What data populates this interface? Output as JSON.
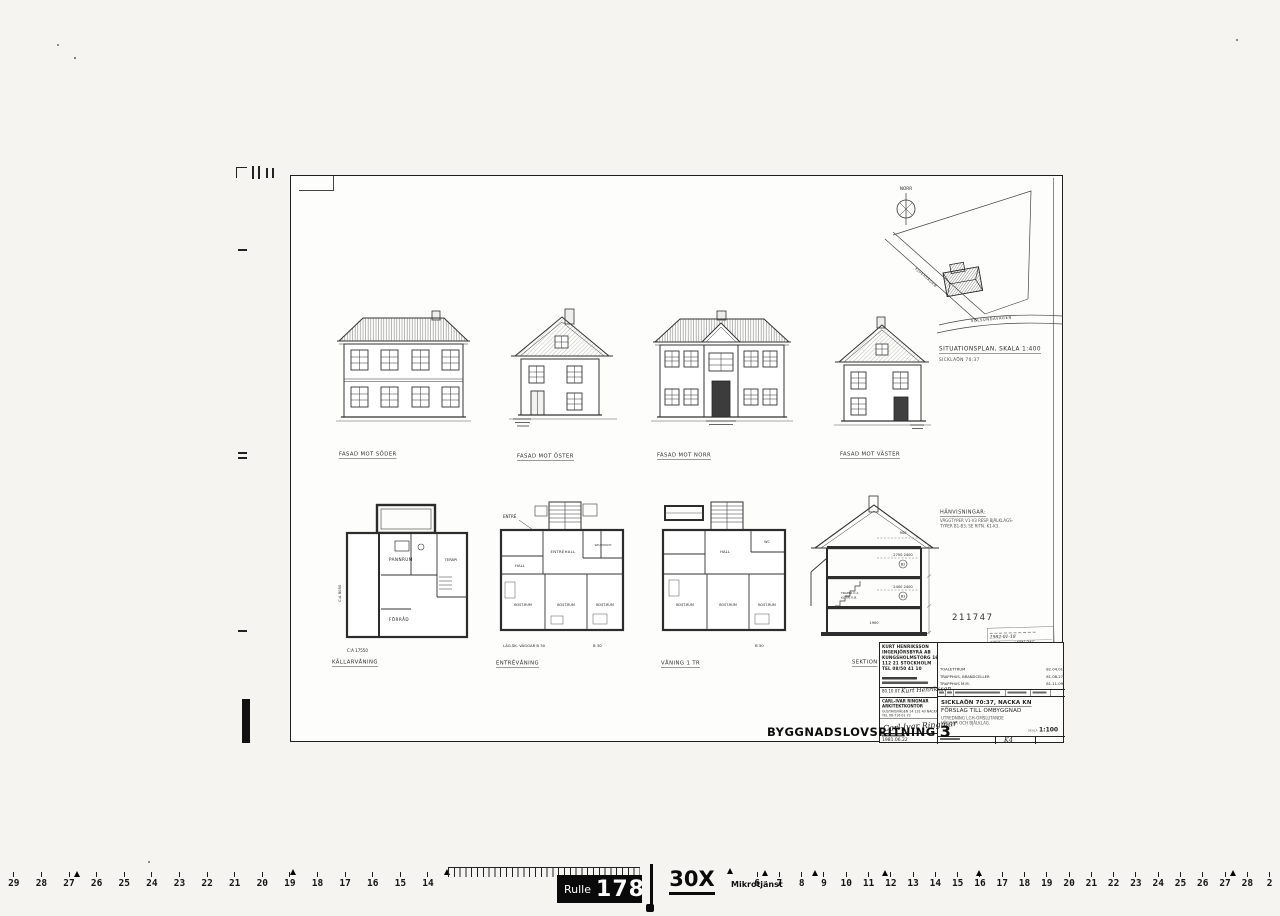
{
  "sheet": {
    "drawing_type_label": "BYGGNADSLOVSRITNING",
    "drawing_sheet_number": "3",
    "stamp_number": "211747"
  },
  "facades": {
    "south_label": "FASAD MOT SÖDER",
    "east_label": "FASAD MOT ÖSTER",
    "north_label": "FASAD MOT NORR",
    "west_label": "FASAD MOT VÄSTER"
  },
  "siteplan": {
    "north": "NORR",
    "street_diagonal": "EJDERVÄGEN",
    "street_bottom": "SOLSUNDAVÄGEN",
    "title": "SITUATIONSPLAN, SKALA 1:400",
    "subtitle": "SICKLAÖN 70:37"
  },
  "plans": {
    "basement_label": "KÄLLARVÅNING",
    "entry_label": "ENTRÉVÅNING",
    "floor1_label": "VÅNING 1 TR",
    "section_label": "SEKTION",
    "basement": {
      "room1": "PANNRUM",
      "room2": "TERAPI",
      "room3": "FÖRRÅD",
      "dim_bottom": "C:A 17550",
      "dim_left": "C:A 8050"
    },
    "entry": {
      "entry": "ENTRÉ",
      "hall_big": "ENTRÉHALL",
      "wc": "WC/DUSCH",
      "hall": "HALL",
      "room": "BOST.RUM",
      "note_left": "LÄG.SK. VÄGGAR  B 30",
      "note_right": "B 30"
    },
    "floor1": {
      "wc": "WC",
      "hall": "HALL",
      "room": "BOST.RUM",
      "note": "B 30"
    },
    "section": {
      "dim_attic": "900",
      "dim_upper": "2700  2400",
      "marker_upper": "B2",
      "dim_lower": "2400  2400",
      "marker_lower": "B3",
      "dim_basement": "1900",
      "stair_note1": "TRAPPA  C:A",
      "stair_note2": "KL.FRI  K.B."
    }
  },
  "notes": {
    "heading": "HÄNVISNINGAR:",
    "line1": "VÄGGTYPER V1-V3 RESP BJÄLKLAGS-",
    "line2": "TYPER B1-B3, SE RITN. K1-K3."
  },
  "titleblock": {
    "engineer_lines": [
      "KURT HENRIKSSON",
      "INGENJÖRSBYRÅ AB",
      "KUNGSHOLMSTORG 16",
      "112 21 STOCKHOLM",
      "TEL 08/50 41 10"
    ],
    "engineer_date": "80.10.07",
    "engineer_signature": "Kurt Henriksson",
    "architect_name": "CARL-IVAR RINGMAR ARKITEKTKONTOR",
    "architect_addr": "GUSTAVSVÄGEN 14    131 40 NACKA",
    "architect_tel": "TEL 08-716 01 72",
    "architect_signature": "Carl-Ivar Ringmar",
    "date": "1981.06.22",
    "revisions": [
      {
        "text": "TOALETTRUM",
        "date": "82.04.01"
      },
      {
        "text": "TRAPPHUS, BRANDCELLER",
        "date": "81.08.27"
      },
      {
        "text": "TRAPPHUS  M.M.",
        "date": "81.11.09"
      }
    ],
    "project_title": "SICKLAÖN 70:37, NACKA KN",
    "project_subtitle": "FÖRSLAG TILL OMBYGGNAD",
    "project_desc1": "UTREDNING LGH-OMSLUTANDE",
    "project_desc2": "VÄGGAR OCH BJÄLKLAG.",
    "scale_label": "SKALA",
    "scale_value": "1:100",
    "drawing_number": "K4",
    "stamp_line1": "1982-01-18",
    "stamp_line2": "AF 2",
    "stamp_line3": "KW 345"
  },
  "film_strip": {
    "roll_label": "Rulle",
    "roll_number": "178",
    "magnification": "30X",
    "service": "Mikrotjänst",
    "left_numbers": [
      "29",
      "28",
      "27",
      "26",
      "25",
      "24",
      "23",
      "22",
      "21",
      "20",
      "19",
      "18",
      "17",
      "16",
      "15",
      "14"
    ],
    "right_numbers": [
      "6",
      "7",
      "8",
      "9",
      "10",
      "11",
      "12",
      "13",
      "14",
      "15",
      "16",
      "17",
      "18",
      "19",
      "20",
      "21",
      "22",
      "23",
      "24",
      "25",
      "26",
      "27",
      "28",
      "2"
    ]
  }
}
